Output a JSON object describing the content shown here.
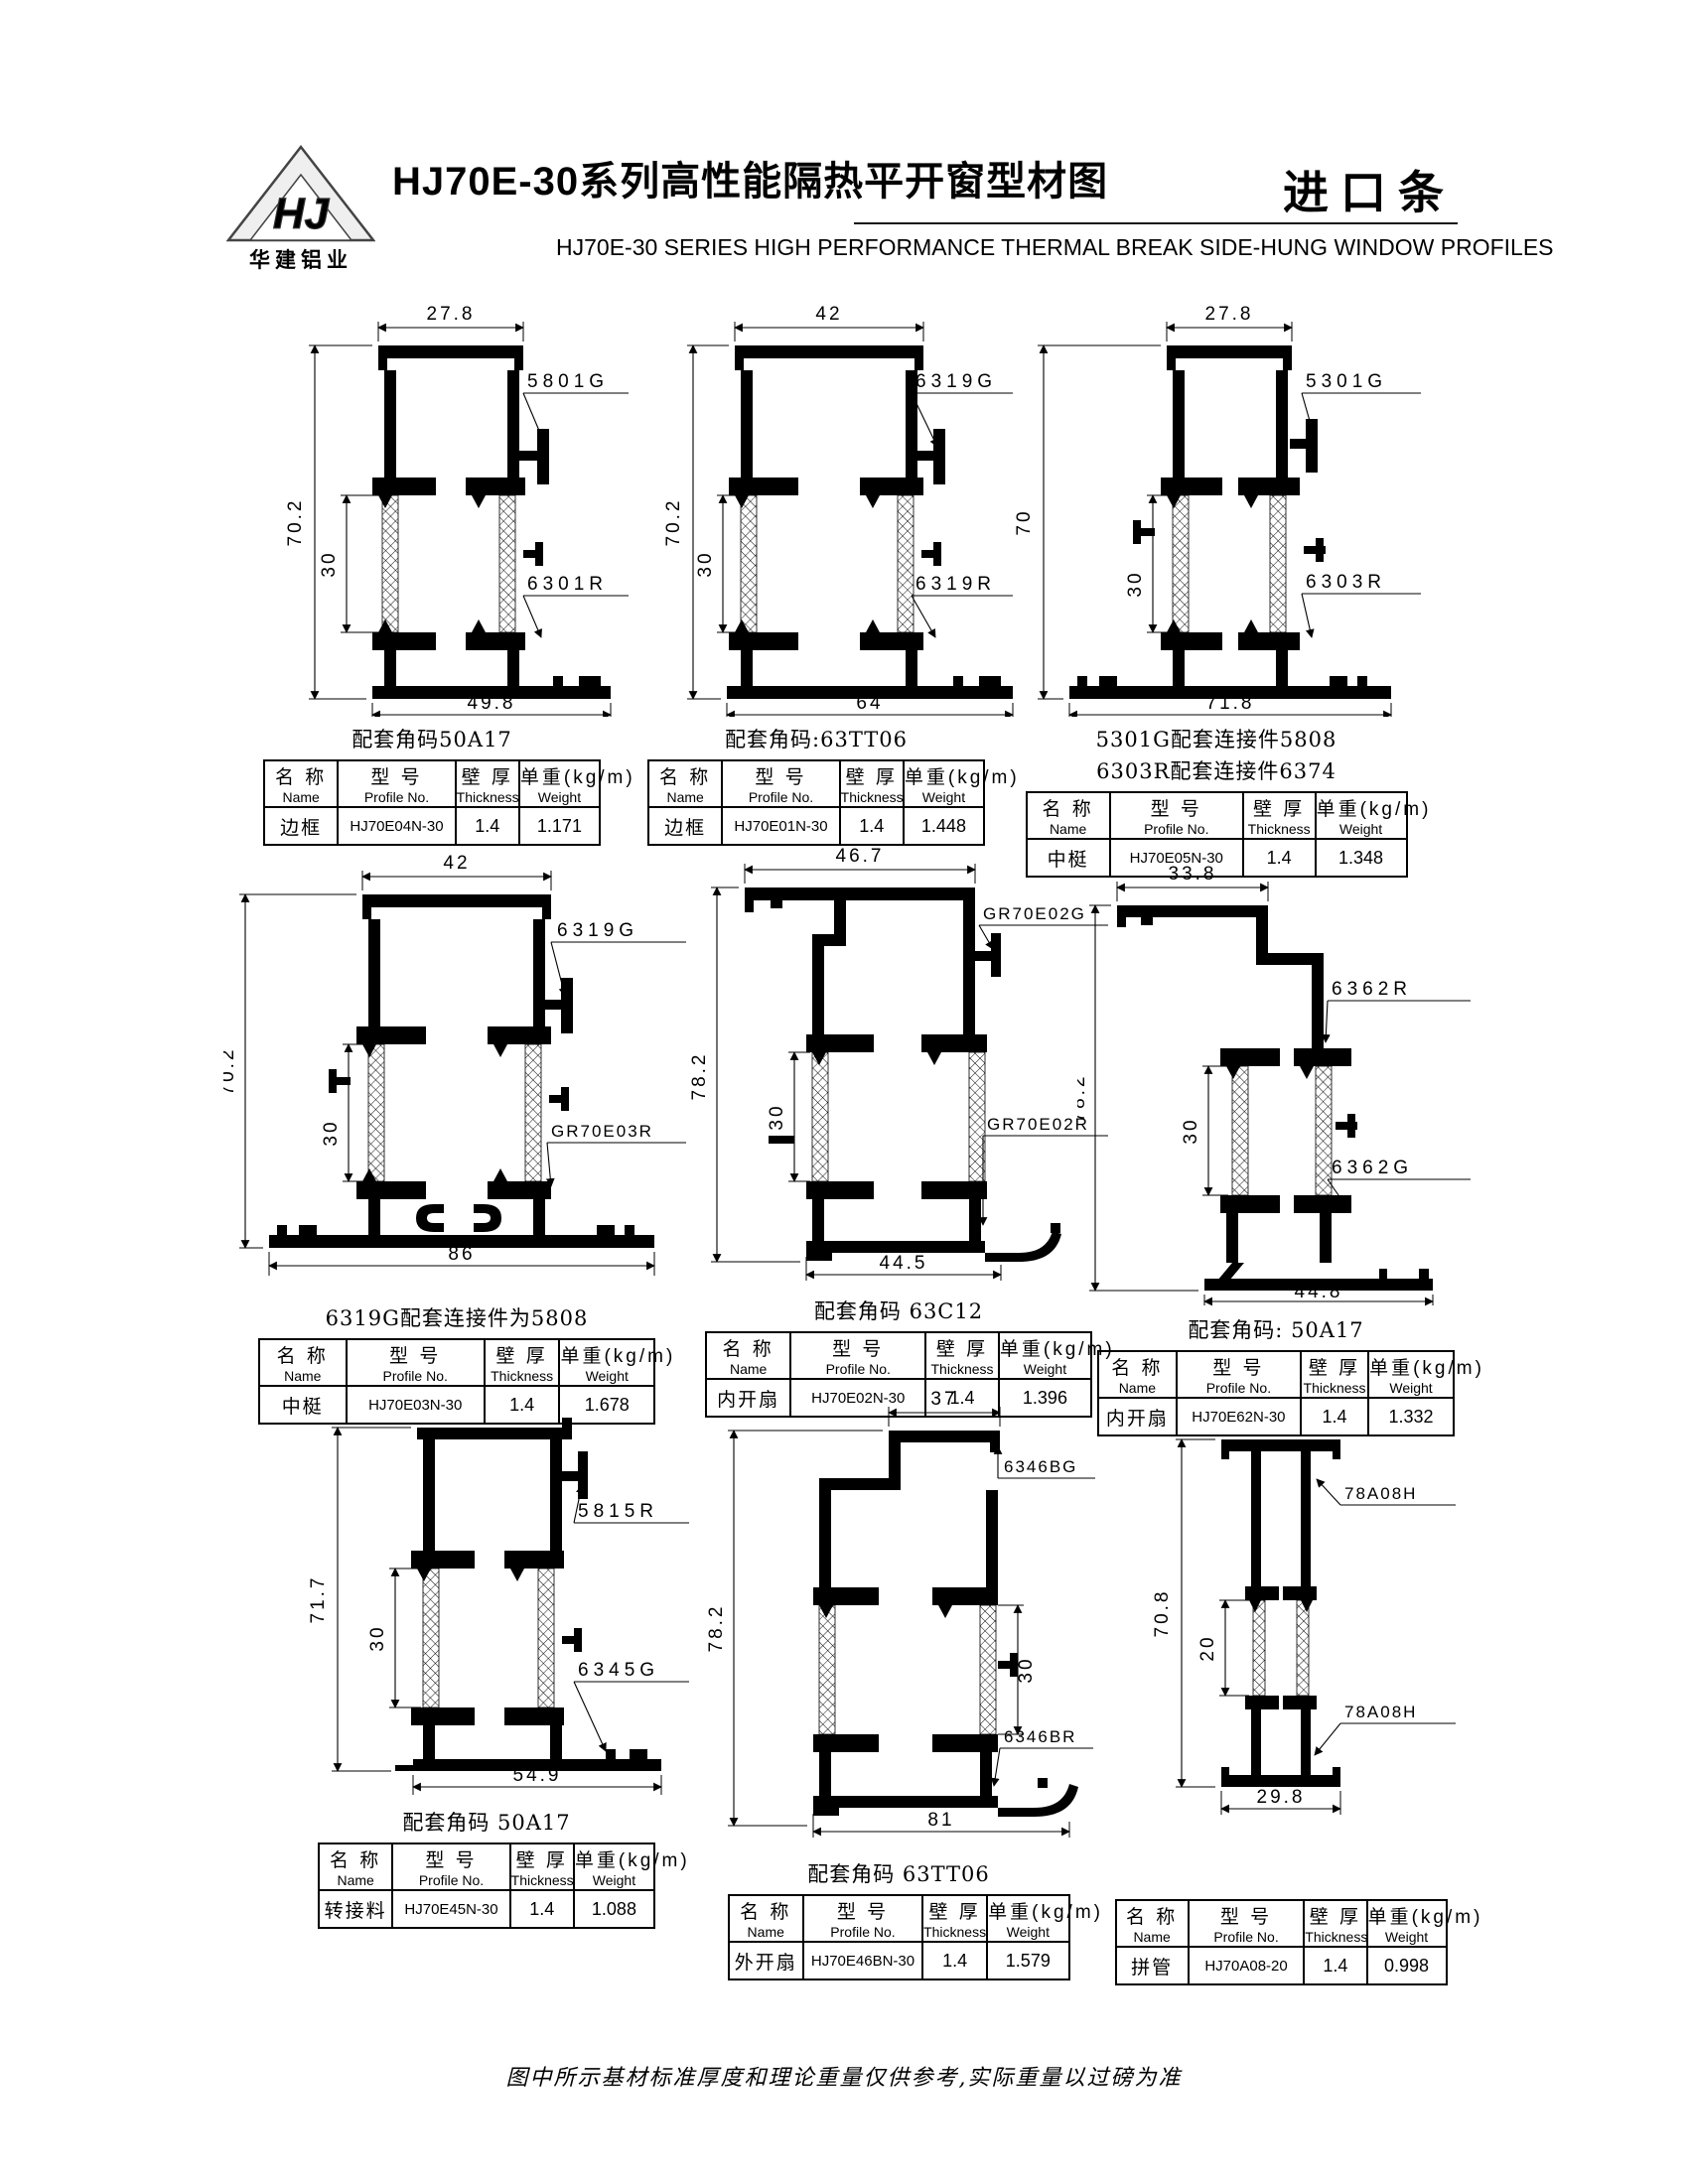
{
  "header": {
    "logo_monogram": "HJ",
    "logo_text": "华建铝业",
    "title": "HJ70E-30系列高性能隔热平开窗型材图",
    "stamp": "进口条",
    "subtitle": "HJ70E-30  SERIES HIGH PERFORMANCE THERMAL BREAK SIDE-HUNG  WINDOW  PROFILES"
  },
  "table_headers": {
    "name_cn": "名 称",
    "name_en": "Name",
    "model_cn": "型 号",
    "model_en": "Profile No.",
    "thickness_cn": "壁 厚",
    "thickness_en": "Thickness",
    "weight_cn": "单重(kg/m)",
    "weight_en": "Weight"
  },
  "cells": [
    {
      "dims": {
        "top": "27.8",
        "overall": "70.2",
        "inner": "30",
        "bottom": "49.8"
      },
      "labels": {
        "upper": "5801G",
        "lower": "6301R"
      },
      "captions": [
        "配套角码50A17"
      ],
      "table": {
        "name": "边框",
        "profile_no": "HJ70E04N-30",
        "thickness": "1.4",
        "weight": "1.171"
      }
    },
    {
      "dims": {
        "top": "42",
        "overall": "70.2",
        "inner": "30",
        "bottom": "64"
      },
      "labels": {
        "upper": "6319G",
        "lower": "6319R"
      },
      "captions": [
        "配套角码:63TT06"
      ],
      "table": {
        "name": "边框",
        "profile_no": "HJ70E01N-30",
        "thickness": "1.4",
        "weight": "1.448"
      }
    },
    {
      "dims": {
        "top": "27.8",
        "overall": "70",
        "inner": "30",
        "bottom": "71.8"
      },
      "labels": {
        "upper": "5301G",
        "lower": "6303R"
      },
      "captions": [
        "5301G配套连接件5808",
        "6303R配套连接件6374"
      ],
      "table": {
        "name": "中梃",
        "profile_no": "HJ70E05N-30",
        "thickness": "1.4",
        "weight": "1.348"
      }
    },
    {
      "dims": {
        "top": "42",
        "overall": "70.2",
        "inner": "30",
        "bottom": "86"
      },
      "labels": {
        "upper": "6319G",
        "lower": "GR70E03R"
      },
      "captions": [
        "6319G配套连接件为5808"
      ],
      "table": {
        "name": "中梃",
        "profile_no": "HJ70E03N-30",
        "thickness": "1.4",
        "weight": "1.678"
      }
    },
    {
      "dims": {
        "top": "46.7",
        "overall": "78.2",
        "inner": "30",
        "bottom": "44.5"
      },
      "labels": {
        "upper": "GR70E02G",
        "lower": "GR70E02R"
      },
      "captions": [
        "配套角码 63C12"
      ],
      "table": {
        "name": "内开扇",
        "profile_no": "HJ70E02N-30",
        "thickness": "1.4",
        "weight": "1.396"
      }
    },
    {
      "dims": {
        "top": "33.8",
        "overall": "78.2",
        "inner": "30",
        "bottom": "44.8"
      },
      "labels": {
        "upper": "6362R",
        "lower": "6362G"
      },
      "captions": [
        "配套角码: 50A17"
      ],
      "table": {
        "name": "内开扇",
        "profile_no": "HJ70E62N-30",
        "thickness": "1.4",
        "weight": "1.332"
      }
    },
    {
      "dims": {
        "overall": "71.7",
        "inner": "30",
        "bottom": "54.9"
      },
      "labels": {
        "upper": "5815R",
        "lower": "6345G"
      },
      "captions": [
        "配套角码 50A17"
      ],
      "table": {
        "name": "转接料",
        "profile_no": "HJ70E45N-30",
        "thickness": "1.4",
        "weight": "1.088"
      }
    },
    {
      "dims": {
        "top": "37",
        "overall": "78.2",
        "inner": "30",
        "bottom": "81"
      },
      "labels": {
        "upper": "6346BG",
        "lower": "6346BR"
      },
      "captions": [
        "配套角码 63TT06"
      ],
      "table": {
        "name": "外开扇",
        "profile_no": "HJ70E46BN-30",
        "thickness": "1.4",
        "weight": "1.579"
      }
    },
    {
      "dims": {
        "overall": "70.8",
        "inner": "20",
        "bottom": "29.8"
      },
      "labels": {
        "upper": "78A08H",
        "lower": "78A08H"
      },
      "captions": [],
      "table": {
        "name": "拼管",
        "profile_no": "HJ70A08-20",
        "thickness": "1.4",
        "weight": "0.998"
      }
    }
  ],
  "footer": "图中所示基材标准厚度和理论重量仅供参考,实际重量以过磅为准"
}
